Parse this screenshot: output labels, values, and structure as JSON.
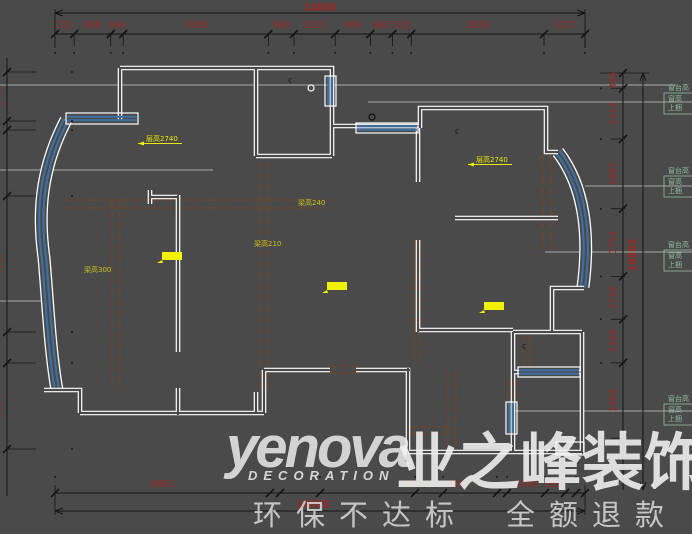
{
  "colors": {
    "background": "#4a4a4a",
    "dimension_red": "#9c2823",
    "wall_white": "#ffffff",
    "window_blue": "#3f6f9e",
    "beam_brown": "#6f4527",
    "highlight_yellow": "#f2f200",
    "note_green": "#8fbf9f",
    "leader_gray": "#a8a8a8",
    "line_black": "#141414"
  },
  "watermark": {
    "brand": "yenova",
    "brand_sub": "DECORATION",
    "brand_cn": "业之峰装饰",
    "slogan_left": "环保不达标",
    "slogan_right": "全额退款"
  },
  "dimensions": {
    "top": {
      "total": "14800",
      "segments": [
        "522",
        "998",
        "340",
        "3958",
        "698",
        "1123",
        "960",
        "603",
        "513",
        "3620",
        "1117"
      ]
    },
    "bottom": {
      "total": "14988",
      "labels": [
        {
          "text": "6063",
          "x": 162
        },
        {
          "text": "240",
          "x": 413
        },
        {
          "text": "1590",
          "x": 457
        },
        {
          "text": "1060",
          "x": 527
        },
        {
          "text": "960",
          "x": 554
        }
      ]
    },
    "right": {
      "total": "10802",
      "segments": [
        "395",
        "1314",
        "1807",
        "1753",
        "1110",
        "1129",
        "1954"
      ]
    },
    "left": {
      "segments": [
        {
          "text": "1495",
          "y": 96
        },
        {
          "text": "4110",
          "y": 264
        },
        {
          "text": "3004",
          "y": 406
        }
      ]
    }
  },
  "plan": {
    "beam_labels": [
      {
        "text": "梁高240",
        "x": 298,
        "y": 205
      },
      {
        "text": "梁高210",
        "x": 254,
        "y": 246
      },
      {
        "text": "梁高300",
        "x": 84,
        "y": 272
      }
    ],
    "room_labels": [
      {
        "text": "层高2740",
        "x": 146,
        "y": 141
      },
      {
        "text": "层高2740",
        "x": 476,
        "y": 162
      }
    ],
    "highlights": [
      {
        "x": 162,
        "y": 252
      },
      {
        "x": 327,
        "y": 282
      },
      {
        "x": 484,
        "y": 302
      }
    ],
    "side_notes": {
      "lines": [
        "窗台高",
        "窗高",
        "上捆"
      ],
      "positions": [
        85,
        168,
        242,
        396
      ]
    }
  }
}
